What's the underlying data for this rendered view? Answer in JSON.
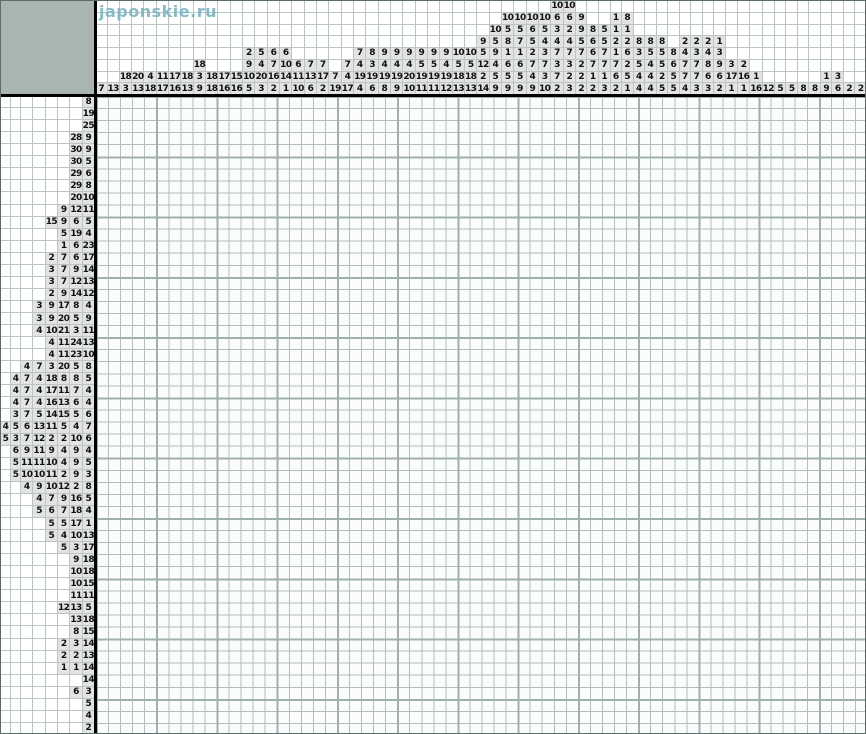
{
  "site": {
    "watermark": "japonskie.ru"
  },
  "board": {
    "columns": 64,
    "rows": 53,
    "state": "empty",
    "filled_cells": []
  },
  "colors": {
    "corner_block": "#a9b5af",
    "separator": "#000000",
    "clue_cell_bg": "#e3e3e3",
    "clue_grid_line": "#b9c6c4",
    "board_bg": "#fbfdfc",
    "board_line_thin": "#b2bfbd",
    "board_line_bold": "#9fb0ae",
    "watermark": "#7db6c4",
    "clue_text": "#101010"
  },
  "top_clues": [
    [
      7
    ],
    [
      13
    ],
    [
      18,
      3
    ],
    [
      20,
      13
    ],
    [
      4,
      18
    ],
    [
      11,
      17
    ],
    [
      17,
      16
    ],
    [
      18,
      13
    ],
    [
      18,
      3,
      9
    ],
    [
      18,
      18
    ],
    [
      17,
      16
    ],
    [
      15,
      16
    ],
    [
      2,
      9,
      10,
      5
    ],
    [
      5,
      4,
      20,
      3
    ],
    [
      6,
      7,
      16,
      2
    ],
    [
      6,
      10,
      14,
      1
    ],
    [
      6,
      11,
      10
    ],
    [
      7,
      13,
      6
    ],
    [
      7,
      17,
      2
    ],
    [
      7,
      19
    ],
    [
      7,
      4,
      17
    ],
    [
      7,
      4,
      19,
      4
    ],
    [
      8,
      3,
      19,
      6
    ],
    [
      9,
      4,
      19,
      8
    ],
    [
      9,
      4,
      19,
      9
    ],
    [
      9,
      4,
      20,
      10
    ],
    [
      9,
      5,
      19,
      11
    ],
    [
      9,
      5,
      19,
      11
    ],
    [
      9,
      4,
      19,
      12
    ],
    [
      10,
      5,
      18,
      13
    ],
    [
      10,
      5,
      18,
      13
    ],
    [
      9,
      5,
      12,
      2,
      14
    ],
    [
      10,
      5,
      9,
      4,
      5,
      9
    ],
    [
      10,
      5,
      8,
      1,
      6,
      5,
      9
    ],
    [
      10,
      5,
      7,
      1,
      6,
      5,
      9
    ],
    [
      10,
      6,
      5,
      2,
      7,
      4,
      9
    ],
    [
      10,
      5,
      4,
      3,
      7,
      3,
      10
    ],
    [
      10,
      6,
      3,
      4,
      7,
      3,
      7,
      2
    ],
    [
      10,
      6,
      2,
      4,
      7,
      3,
      2,
      3
    ],
    [
      9,
      9,
      5,
      7,
      2,
      2,
      2
    ],
    [
      8,
      6,
      6,
      7,
      1,
      2
    ],
    [
      5,
      5,
      7,
      7,
      1,
      3
    ],
    [
      1,
      1,
      2,
      1,
      7,
      6,
      2
    ],
    [
      8,
      1,
      2,
      6,
      2,
      5,
      1
    ],
    [
      8,
      3,
      5,
      4,
      4
    ],
    [
      8,
      5,
      4,
      4,
      4
    ],
    [
      8,
      5,
      5,
      2,
      5
    ],
    [
      8,
      6,
      5,
      5
    ],
    [
      2,
      4,
      7,
      7,
      4
    ],
    [
      2,
      3,
      7,
      7,
      3
    ],
    [
      2,
      4,
      8,
      6,
      3
    ],
    [
      1,
      3,
      9,
      6,
      2
    ],
    [
      3,
      17,
      1
    ],
    [
      2,
      16,
      1
    ],
    [
      1,
      16
    ],
    [
      12
    ],
    [
      5
    ],
    [
      5
    ],
    [
      8
    ],
    [
      8
    ],
    [
      1,
      9
    ],
    [
      3,
      6
    ],
    [
      2
    ],
    [
      2
    ]
  ],
  "left_clues": [
    [
      8
    ],
    [
      19
    ],
    [
      25
    ],
    [
      28,
      9
    ],
    [
      30,
      9
    ],
    [
      30,
      5
    ],
    [
      29,
      6
    ],
    [
      29,
      8
    ],
    [
      20,
      10
    ],
    [
      9,
      12,
      11
    ],
    [
      15,
      9,
      6,
      5
    ],
    [
      5,
      19,
      4
    ],
    [
      1,
      6,
      23
    ],
    [
      2,
      7,
      6,
      17
    ],
    [
      3,
      7,
      9,
      14
    ],
    [
      3,
      7,
      12,
      13
    ],
    [
      2,
      9,
      14,
      12
    ],
    [
      3,
      9,
      17,
      8,
      4
    ],
    [
      3,
      9,
      20,
      5,
      9
    ],
    [
      4,
      10,
      21,
      3,
      11
    ],
    [
      4,
      11,
      24,
      13
    ],
    [
      4,
      11,
      23,
      10
    ],
    [
      4,
      7,
      3,
      20,
      5,
      8
    ],
    [
      4,
      7,
      4,
      18,
      8,
      8,
      5
    ],
    [
      4,
      7,
      4,
      17,
      11,
      7,
      4
    ],
    [
      4,
      7,
      4,
      16,
      13,
      6,
      4
    ],
    [
      3,
      7,
      5,
      14,
      15,
      5,
      6
    ],
    [
      4,
      5,
      6,
      13,
      11,
      5,
      4,
      7
    ],
    [
      5,
      3,
      7,
      12,
      2,
      2,
      10,
      6
    ],
    [
      6,
      9,
      11,
      9,
      4,
      9,
      4
    ],
    [
      5,
      11,
      11,
      10,
      4,
      9,
      5
    ],
    [
      5,
      10,
      10,
      11,
      2,
      9,
      3
    ],
    [
      4,
      9,
      10,
      12,
      2,
      8
    ],
    [
      4,
      7,
      9,
      16,
      5
    ],
    [
      5,
      6,
      7,
      18,
      4
    ],
    [
      5,
      5,
      17,
      1
    ],
    [
      5,
      4,
      10,
      13
    ],
    [
      5,
      3,
      17
    ],
    [
      9,
      18
    ],
    [
      10,
      18
    ],
    [
      10,
      15
    ],
    [
      11,
      11
    ],
    [
      12,
      13,
      5
    ],
    [
      13,
      18
    ],
    [
      8,
      15
    ],
    [
      2,
      3,
      14
    ],
    [
      2,
      2,
      13
    ],
    [
      1,
      1,
      14
    ],
    [
      14
    ],
    [
      6,
      3
    ],
    [
      5
    ],
    [
      4
    ],
    [
      2
    ]
  ]
}
